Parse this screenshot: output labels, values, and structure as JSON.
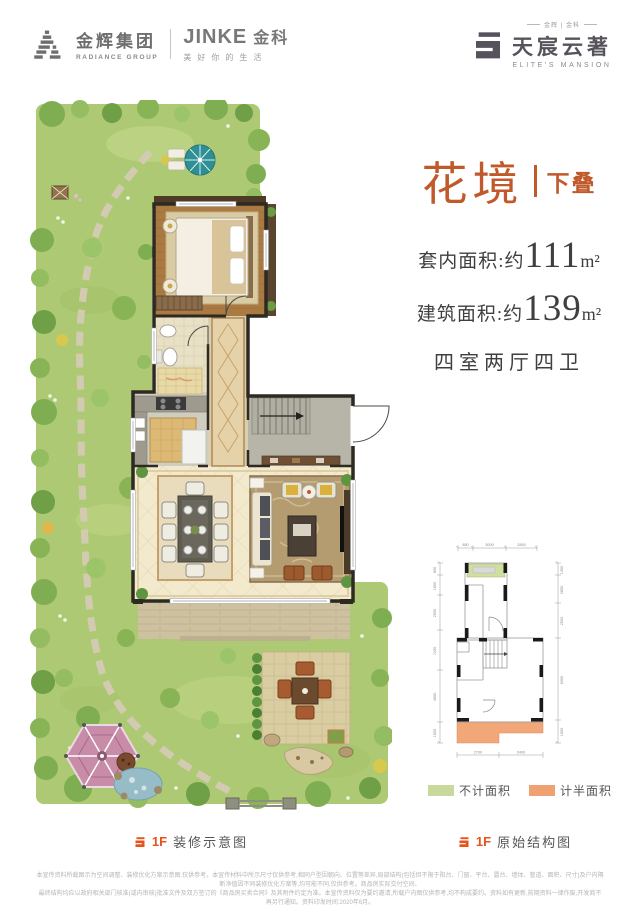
{
  "header": {
    "radiance": {
      "cn": "金辉集团",
      "en": "RADIANCE GROUP"
    },
    "jinke": {
      "name": "JINKE",
      "cn": "金科",
      "tagline": "美好你的生活"
    },
    "brand": {
      "pre": "金辉 | 金科",
      "cn": "天宸云著",
      "en": "ELITE'S MANSION"
    }
  },
  "info": {
    "title": "花境",
    "subtitle": "下叠",
    "area1_label": "套内面积:约",
    "area1_value": "111",
    "area1_unit": "m²",
    "area2_label": "建筑面积:约",
    "area2_value": "139",
    "area2_unit": "m²",
    "rooms": "四室两厅四卫"
  },
  "captions": {
    "left_floor": "1F",
    "left_text": "装修示意图",
    "right_floor": "1F",
    "right_text": "原始结构图"
  },
  "legend": {
    "items": [
      {
        "label": "不计面积",
        "color": "#c8d99b"
      },
      {
        "label": "计半面积",
        "color": "#efa172"
      }
    ]
  },
  "structural": {
    "dims_top": [
      "850",
      "3000",
      "2850"
    ],
    "dims_left": [
      "850",
      "1800",
      "2500",
      "7200",
      "4600",
      "1500"
    ],
    "dims_right": [
      "1350",
      "2850",
      "2500",
      "6000",
      "1500"
    ],
    "dims_bottom": [
      "2700",
      "2400"
    ]
  },
  "footer": {
    "line1": "本宣传资料所载图示为空间调整、装修优化方案示意图,仅供参考。本宣传材料中所示尺寸仅供参考,相同户型因朝向、位置等差异,局部结构(包括但不限于阳台、门窗、平台、露台、墙体、管道、面积、尺寸)及户内隔断净值因不同装修优化方案等,均可能不同,仅供参考。商品房实际交付空间、",
    "line2": "最终结构均应以政府相关部门核准(或内审核)批准文件及双方签订的《商品房买卖合同》及其附件约定为准。本宣传资料仅为要约邀请,所载户内图仅供参考,均不构成要约。资料如有更新,前期资料一律作废,开发商不再另行通知。资料印发时间:2020年6月。"
  },
  "colors": {
    "title_orange": "#c05a2b",
    "caption_orange": "#e8521c",
    "legend_green": "#c8d99b",
    "legend_orange": "#efa172",
    "text_dark": "#3f3f3f"
  }
}
